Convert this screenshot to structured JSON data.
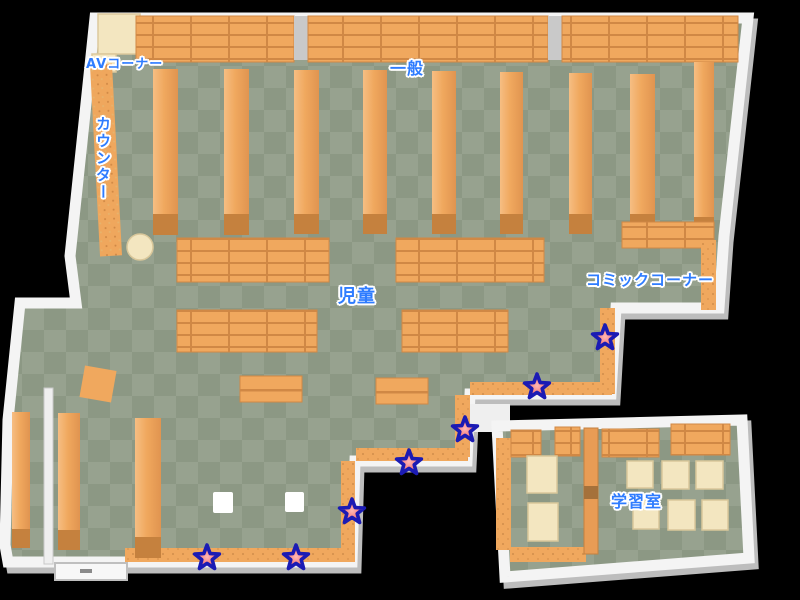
{
  "map": {
    "title_labels": {
      "av_corner": "AVコーナー",
      "counter": "カウンター",
      "general": "一般",
      "children": "児童",
      "comic_corner": "コミックコーナー",
      "study_room": "学習室"
    },
    "markers": [
      {
        "x": 605,
        "y": 338
      },
      {
        "x": 537,
        "y": 387
      },
      {
        "x": 465,
        "y": 430
      },
      {
        "x": 409,
        "y": 463
      },
      {
        "x": 352,
        "y": 512
      },
      {
        "x": 207,
        "y": 558
      },
      {
        "x": 296,
        "y": 558
      }
    ],
    "colors": {
      "floor_light": "#97A28F",
      "floor_dark": "#8C9884",
      "shelf_orange": "#F0A85E",
      "shelf_line": "#D08845",
      "shelf_end": "#C5813E",
      "wall_white": "#F4F4F4",
      "wall_shadow": "#BDBDBD",
      "cream": "#F3E6C0",
      "label_blue": "#2E7CFF",
      "star_fill": "#F25C5C",
      "star_outline": "#1B1BB4"
    }
  }
}
